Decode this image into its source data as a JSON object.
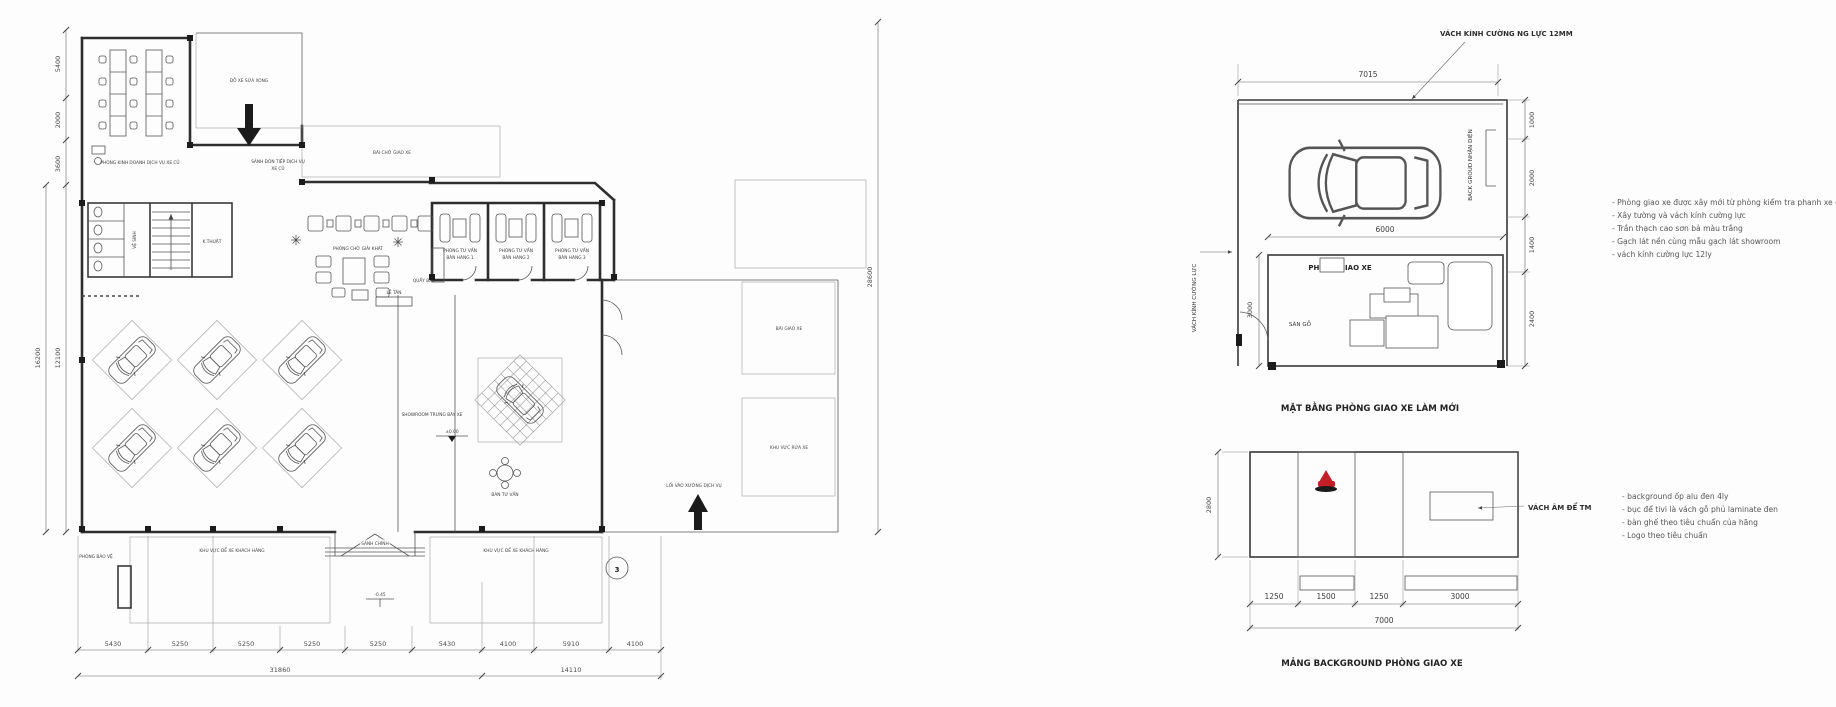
{
  "colors": {
    "accent_red": "#c22026",
    "line": "#3c3c3c",
    "paper": "#fdfdfd"
  },
  "plan": {
    "labels": {
      "office": "PHÒNG KINH DOANH DỊCH VỤ XE CŨ",
      "service_lobby_line1": "SẢNH ĐÓN TIẾP DỊCH VỤ",
      "service_lobby_line2": "XE CŨ",
      "repaired_parking": "ĐỖ XE SỬA XONG",
      "delivery_wait_yard": "BÃI CHỜ GIAO XE",
      "lounge": "PHÒNG CHỜ GIẢI KHÁT",
      "bar": "QUẦY BAR",
      "consult_line1": "PHÒNG TƯ VẤN",
      "consult_1": "BÁN HÀNG 1",
      "consult_2": "BÁN HÀNG 2",
      "consult_3": "BÁN HÀNG 3",
      "wc": "VỆ SINH",
      "tech": "K.THUẬT",
      "reception": "LỄ TÂN",
      "showroom": "SHOWROOM TRƯNG BÀY XE",
      "consult_table": "BÀN TƯ VẤN",
      "main_lobby": "SẢNH CHÍNH",
      "guard": "PHÒNG BẢO VỆ",
      "customer_parking": "KHU VỰC ĐỂ XE KHÁCH HÀNG",
      "workshop_entry": "LỐI VÀO XƯỞNG DỊCH VỤ",
      "delivery_yard": "BÃI GIAO XE",
      "wash_area": "KHU VỰC RỬA XE"
    },
    "levels": {
      "showroom": "±0.00",
      "entrance": "-0.45"
    },
    "marker": "3",
    "dims": {
      "left": [
        "5400",
        "2000",
        "3600",
        "12100"
      ],
      "left_total": "16200",
      "right_total": "28600",
      "bottom": [
        "5430",
        "5250",
        "5250",
        "5250",
        "5250",
        "5430",
        "4100",
        "5910",
        "4100"
      ],
      "bottom_totals": [
        "31860",
        "14110"
      ]
    }
  },
  "delivery_room_plan": {
    "caption": "MẶT BẰNG PHÒNG GIAO XE LÀM MỚI",
    "leader_note": "VÁCH KÍNH CƯỜNG NG LỰC 12MM",
    "room_label": "PHÒNG GIAO XE",
    "floor_label": "SÀN GỖ",
    "left_wall_label": "VÁCH KÍNH CƯỜNG LỰC",
    "backdrop_label": "BACK GROUD NHẬN DIỆN",
    "dims": {
      "top": "7015",
      "car_zone": "6000",
      "room_height": "3000",
      "right": [
        "1000",
        "2000",
        "1400",
        "2400"
      ]
    },
    "notes": [
      "- Phòng giao xe được xây mới từ phòng kiểm tra phanh xe cũ",
      "- Xây tường và vách kính cường lực",
      "- Trần thạch cao sơn bả màu trắng",
      "- Gạch lát nền cùng mẫu gạch lát showroom",
      "- vách kính cường lực 12ly"
    ]
  },
  "background_panel": {
    "caption": "MẢNG BACKGROUND PHÒNG GIAO XE",
    "recess_label": "VÁCH ÂM ĐỂ TM",
    "dims": {
      "height": "2800",
      "segments": [
        "1250",
        "1500",
        "1250",
        "3000"
      ],
      "total": "7000"
    },
    "notes": [
      "- background ốp alu đen 4ly",
      "- bục để tivi là vách gỗ phủ laminate đen",
      "- bàn ghế theo tiêu chuẩn của hãng",
      "- Logo theo tiêu chuẩn"
    ]
  }
}
